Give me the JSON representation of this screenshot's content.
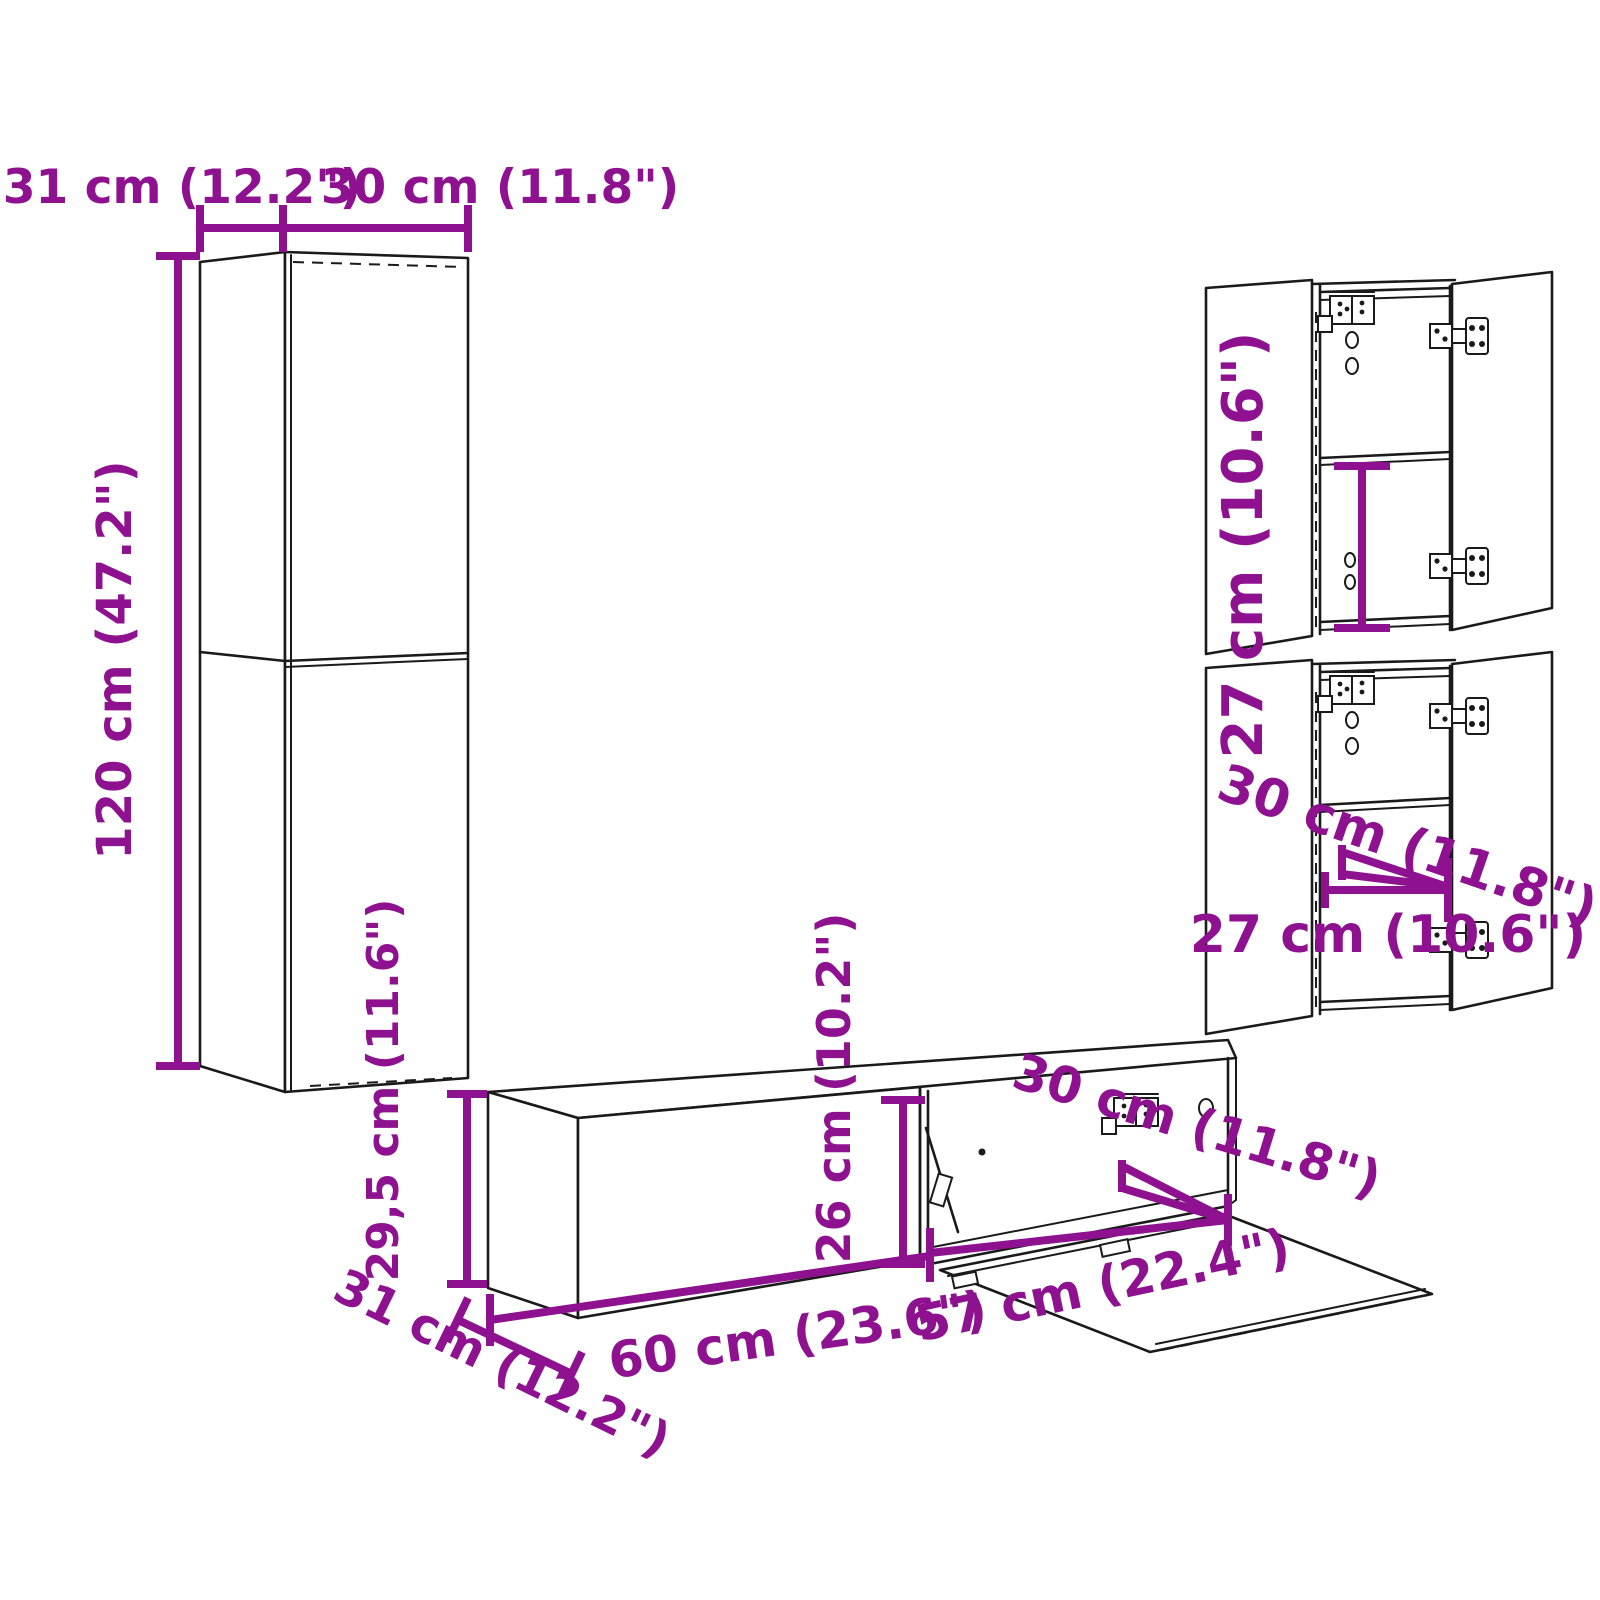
{
  "colors": {
    "dimension_accent": "#8E1190",
    "outline": "#1A1A1A",
    "background": "#FFFFFF"
  },
  "left_cabinet": {
    "depth_label": "31 cm (12.2\")",
    "width_label": "30 cm (11.8\")",
    "height_label": "120 cm (47.2\")"
  },
  "right_cabinet": {
    "inner_height_label": "27 cm (10.6\")",
    "depth_label": "30 cm (11.8\")",
    "inner_width_label": "27 cm (10.6\")"
  },
  "tv_cabinet": {
    "height_label": "29,5 cm (11.6\")",
    "inner_height_label": "26 cm (10.2\")",
    "depth_label": "31 cm (12.2\")",
    "width_label": "60 cm (23.6\")",
    "inner_width_label": "57 cm (22.4\")",
    "compartment_depth_label": "30 cm (11.8\")"
  }
}
